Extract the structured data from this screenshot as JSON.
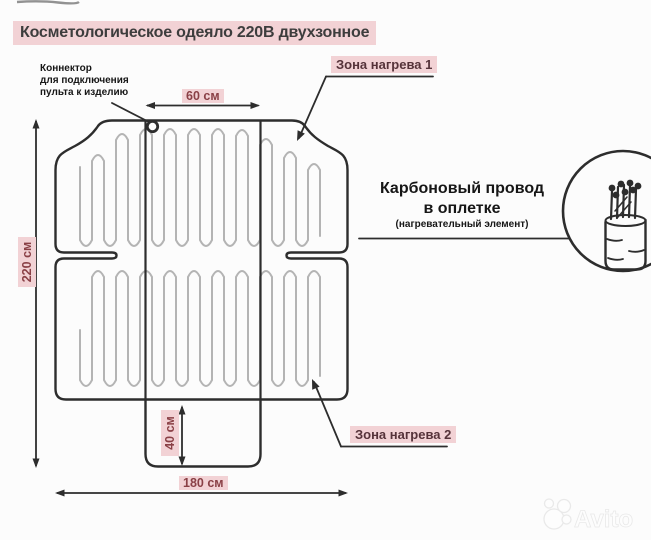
{
  "title": "Косметологическое одеяло 220В двухзонное",
  "labels": {
    "connector_l1": "Коннектор",
    "connector_l2": "для подключения",
    "connector_l3": "пульта к изделию",
    "zone1": "Зона нагрева 1",
    "zone2": "Зона нагрева 2",
    "cable_l1": "Карбоновый провод",
    "cable_l2": "в оплетке",
    "cable_l3": "(нагревательный элемент)"
  },
  "dims": {
    "height": "220 см",
    "width": "180 см",
    "center_width": "60 см",
    "flap_height": "40 см"
  },
  "watermark": "Avito",
  "colors": {
    "highlight_pink": "#f2d2d5",
    "dim_text": "#8a4046",
    "zone_text": "#56333a",
    "outline": "#2d2d2d",
    "heating_wire": "#b4b4b4"
  }
}
